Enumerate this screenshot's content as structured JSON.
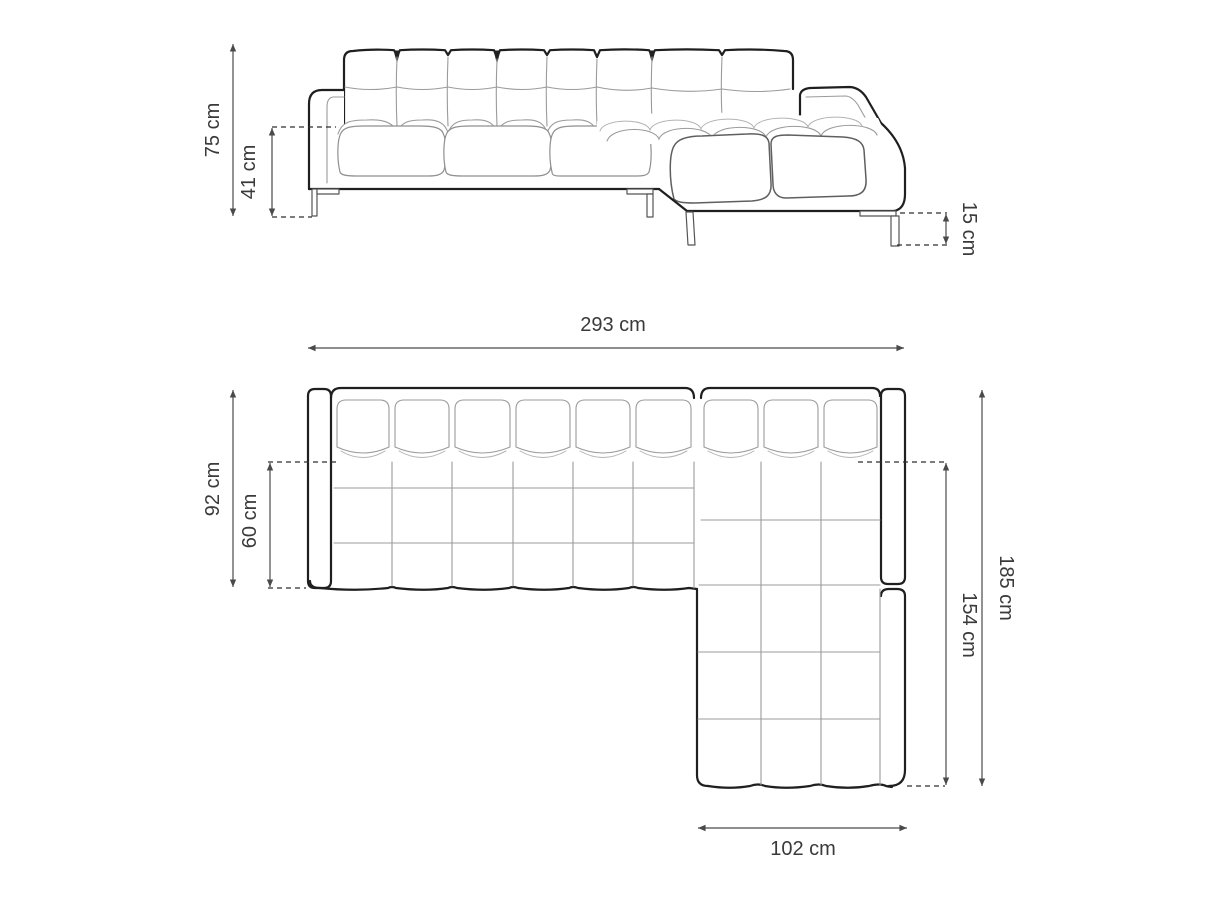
{
  "diagram": {
    "subject": "corner sofa with chaise - dimension drawing",
    "background": "#ffffff"
  },
  "colors": {
    "outline_bold": "#1f1f1f",
    "line_medium": "#5f5f5f",
    "line_light": "#9b9b9b",
    "dimension_line": "#4a4a4a",
    "label_text": "#3a3a3a"
  },
  "views": {
    "front": {
      "dims": {
        "total_height": "75 cm",
        "seat_height": "41 cm",
        "leg_height": "15 cm"
      }
    },
    "top": {
      "dims": {
        "total_width": "293 cm",
        "total_depth": "92 cm",
        "seat_depth": "60 cm",
        "chaise_outer_length": "185 cm",
        "chaise_inner_length": "154 cm",
        "chaise_width": "102 cm"
      }
    }
  }
}
